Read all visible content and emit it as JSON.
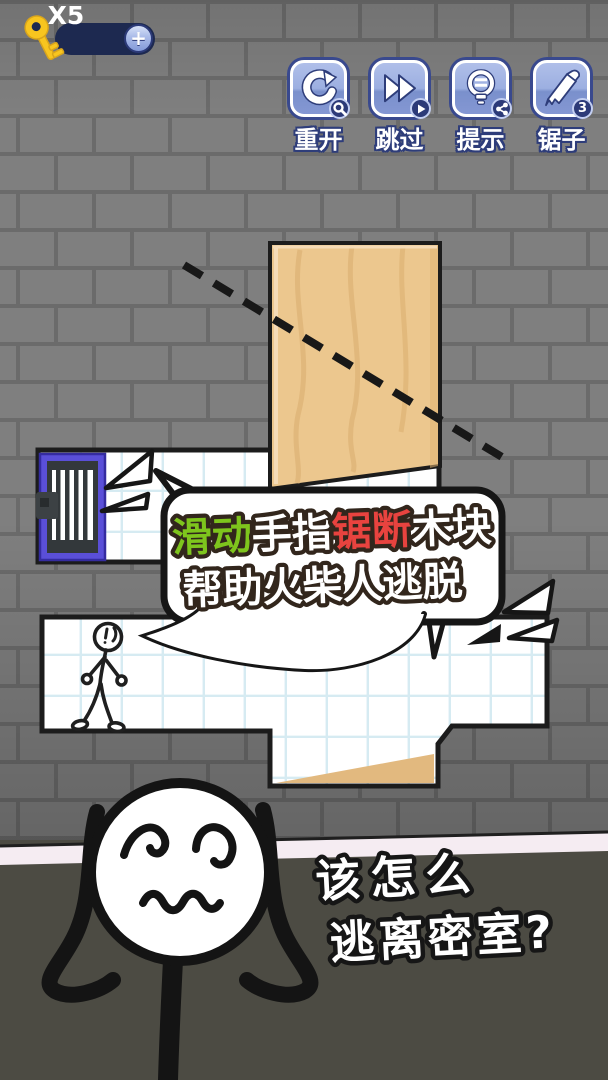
{
  "hud": {
    "keys": {
      "count_label": "X5",
      "plus_label": "+"
    },
    "buttons": [
      {
        "label": "重开",
        "badge_icon": "magnifier-key-badge"
      },
      {
        "label": "跳过",
        "badge_icon": "play-badge"
      },
      {
        "label": "提示",
        "badge_icon": "share-badge"
      },
      {
        "label": "锯子",
        "badge_count": "3"
      }
    ]
  },
  "tutorial_bubble": {
    "line1": [
      {
        "text": "滑动",
        "color": "#7ec51d"
      },
      {
        "text": "手指",
        "color": "#ffffff"
      },
      {
        "text": "锯断",
        "color": "#e8433f"
      },
      {
        "text": "木块",
        "color": "#ffffff"
      }
    ],
    "line2": "帮助火柴人逃脱"
  },
  "caption": {
    "line1": "该怎么",
    "line2": "逃离密室?"
  },
  "colors": {
    "brick_wall": "#7f7f7f",
    "mortar": "#6b6b6b",
    "wood": "#ecc78e",
    "wood_grain": "#deb375",
    "door_frame_purple": "#5a4fd8",
    "door_dark": "#33383b",
    "tile_line": "#d6ebf2",
    "floor_dark": "#4c4b43",
    "baseboard": "#f5ecf2",
    "button_blue": "#9cafe1",
    "badge_navy": "#2c3a78",
    "key_gold": "#f8c51f",
    "highlight_green": "#7ec51d",
    "highlight_red": "#e8433f"
  }
}
